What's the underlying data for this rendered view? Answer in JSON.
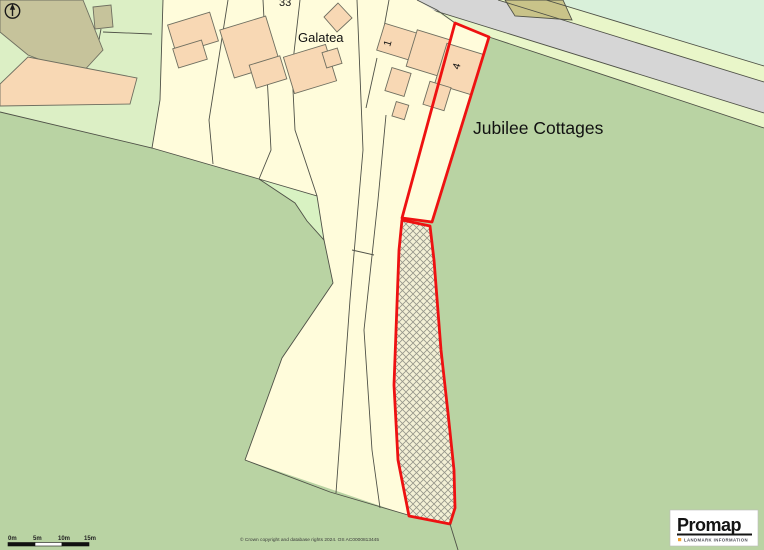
{
  "colors": {
    "field": "#b9d3a3",
    "yard": "#dcefc5",
    "wedge": "#d8f2c2",
    "verge": "#e9f6c9",
    "mint": "#d9f0da",
    "road": "#d6d6d6",
    "cream": "#fffcdb",
    "hatch_bg": "#f3f0d5",
    "hatch_line": "#96968a",
    "peach": "#f8d8b4",
    "khaki": "#c6c39b",
    "khaki_patch": "#c9c389",
    "outline": "#4f5147",
    "building_outline": "#6f6f60",
    "plot_red": "#ee1111",
    "accent_orange": "#f0a030"
  },
  "map": {
    "labels": {
      "jubilee": "Jubilee Cottages",
      "galatea": "Galatea",
      "number_33": "33",
      "house_1": "1",
      "house_4": "4"
    }
  },
  "scale_bar": {
    "ticks": [
      "0m",
      "5m",
      "10m",
      "15m"
    ]
  },
  "attribution": "© Crown copyright and database rights 2024. OS AC0000813445",
  "logo": {
    "brand": "Promap",
    "tagline": "LANDMARK INFORMATION"
  }
}
